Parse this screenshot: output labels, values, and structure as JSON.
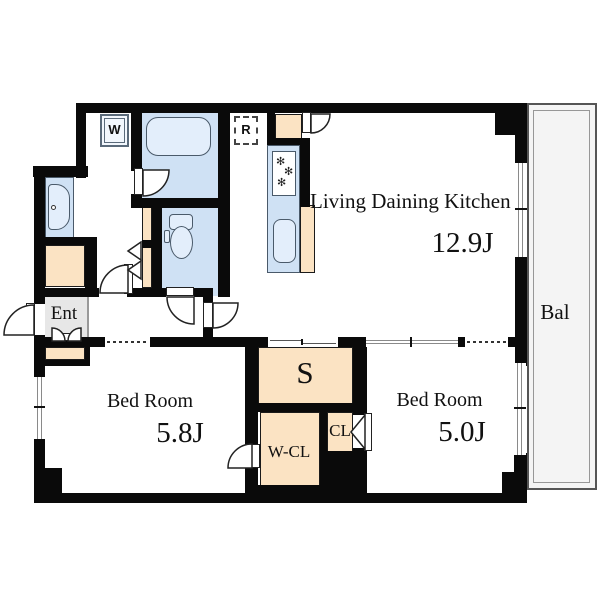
{
  "colors": {
    "wall": "#0a0a0a",
    "water": "#cfe1f4",
    "fixture": "#e3eefb",
    "peach": "#fbe3c3",
    "ent": "#e7e7e7",
    "balcony": "#f4f4f4"
  },
  "rooms": {
    "ldk": {
      "label": "Living Daining Kitchen",
      "size": "12.9J"
    },
    "bedroom1": {
      "label": "Bed Room",
      "size": "5.8J"
    },
    "bedroom2": {
      "label": "Bed Room",
      "size": "5.0J"
    },
    "storage": {
      "label": "S"
    },
    "walk_in_closet": {
      "label": "W-CL"
    },
    "closet": {
      "label": "CL"
    },
    "entrance": {
      "label": "Ent"
    },
    "balcony": {
      "label": "Bal"
    }
  },
  "appliances": {
    "washing_machine": "W",
    "refrigerator": "R"
  }
}
